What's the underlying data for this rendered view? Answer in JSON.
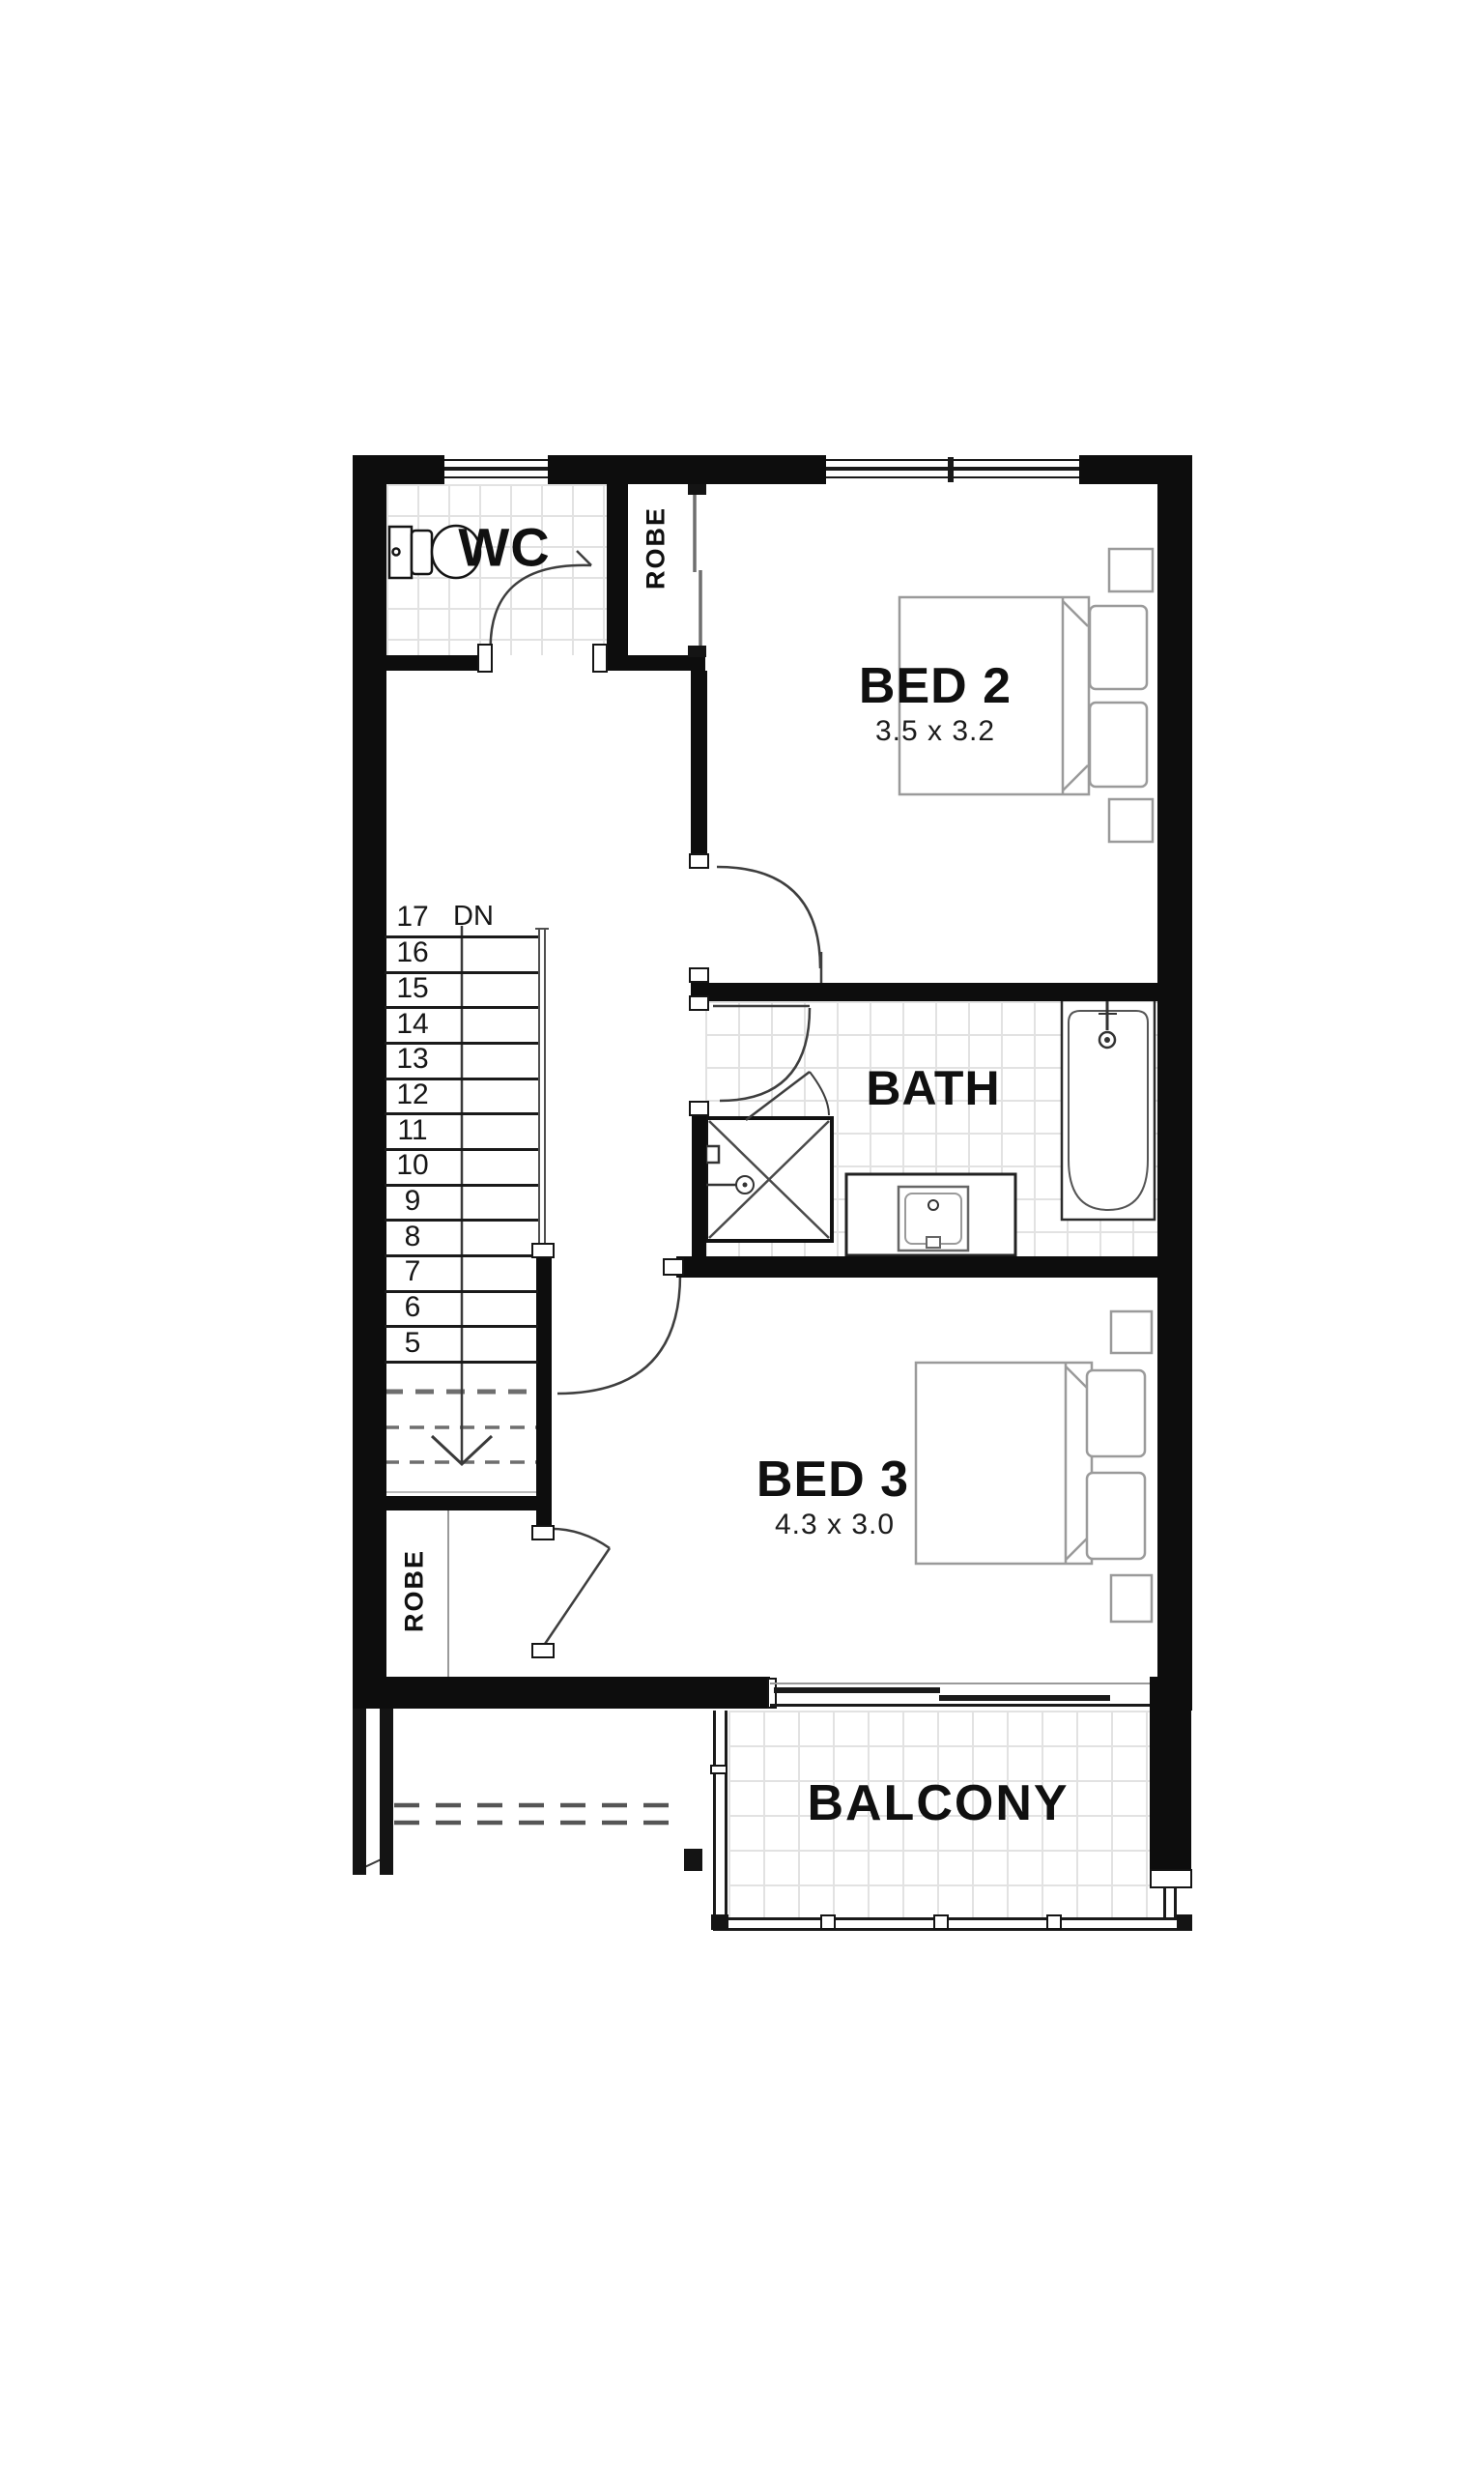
{
  "rooms": {
    "wc": {
      "label": "WC"
    },
    "robe_top": {
      "label": "ROBE"
    },
    "bed2": {
      "label": "BED 2",
      "dims": "3.5 x 3.2"
    },
    "bath": {
      "label": "BATH"
    },
    "bed3": {
      "label": "BED 3",
      "dims": "4.3 x 3.0"
    },
    "robe_bottom": {
      "label": "ROBE"
    },
    "balcony": {
      "label": "BALCONY"
    }
  },
  "stair": {
    "direction_label": "DN",
    "steps": [
      "17",
      "16",
      "15",
      "14",
      "13",
      "12",
      "11",
      "10",
      "9",
      "8",
      "7",
      "6",
      "5"
    ]
  },
  "colors": {
    "wall": "#0d0d0d",
    "tile_line": "#e2e2e2",
    "furniture_line": "#9a9a9a",
    "hidden_line": "#5a5a5a"
  }
}
